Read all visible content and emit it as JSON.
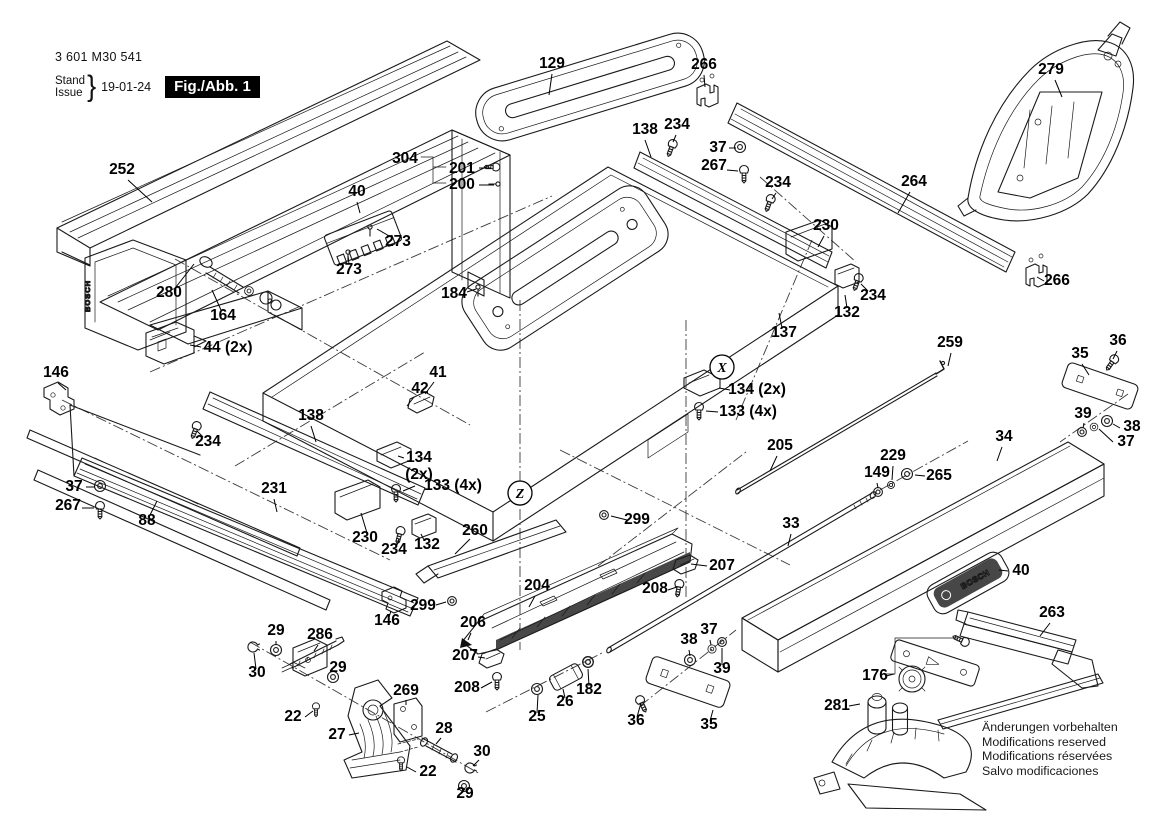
{
  "title_block": {
    "part_number": "3 601 M30 541",
    "stand_label": "Stand",
    "issue_label": "Issue",
    "brace": "}",
    "date": "19-01-24",
    "figure_label": "Fig./Abb. 1"
  },
  "footer_notes": [
    "Änderungen vorbehalten",
    "Modifications reserved",
    "Modifications réservées",
    "Salvo modificaciones"
  ],
  "brand": {
    "logo_text": "BOSCH"
  },
  "colors": {
    "line": "#1a1a1a",
    "label": "#000000",
    "fig_box_bg": "#000000",
    "fig_box_fg": "#ffffff",
    "badge_bg": "#2f2f2f"
  },
  "circled_refs": [
    {
      "letter": "X",
      "x": 722,
      "y": 367
    },
    {
      "letter": "Z",
      "x": 520,
      "y": 493
    }
  ],
  "part_labels": [
    {
      "text": "252",
      "x": 122,
      "y": 174,
      "leader": [
        128,
        180,
        152,
        202
      ]
    },
    {
      "text": "280",
      "x": 169,
      "y": 297,
      "leader": [
        176,
        287,
        194,
        264
      ]
    },
    {
      "text": "164",
      "x": 223,
      "y": 320,
      "leader": [
        221,
        310,
        212,
        290
      ]
    },
    {
      "text": "44 (2x)",
      "x": 228,
      "y": 352,
      "leader": [
        201,
        347,
        190,
        345
      ]
    },
    {
      "text": "146",
      "x": 56,
      "y": 377,
      "leader": [
        58,
        383,
        66,
        390
      ]
    },
    {
      "text": "129",
      "x": 552,
      "y": 68,
      "leader": [
        552,
        74,
        549,
        95
      ]
    },
    {
      "text": "304",
      "x": 405,
      "y": 163
    },
    {
      "text": "201",
      "x": 462,
      "y": 173,
      "leader": [
        479,
        168,
        491,
        168
      ]
    },
    {
      "text": "200",
      "x": 462,
      "y": 189,
      "leader": [
        479,
        185,
        494,
        185
      ]
    },
    {
      "text": "40",
      "x": 357,
      "y": 196,
      "leader": [
        357,
        202,
        360,
        213
      ]
    },
    {
      "text": "273",
      "x": 398,
      "y": 246,
      "leader": [
        391,
        237,
        377,
        229
      ]
    },
    {
      "text": "273",
      "x": 349,
      "y": 274,
      "leader": [
        349,
        264,
        348,
        256
      ]
    },
    {
      "text": "184",
      "x": 454,
      "y": 298,
      "leader": [
        467,
        292,
        476,
        289
      ]
    },
    {
      "text": "266",
      "x": 704,
      "y": 69,
      "leader": [
        704,
        75,
        705,
        87
      ]
    },
    {
      "text": "138",
      "x": 645,
      "y": 134,
      "leader": [
        645,
        140,
        651,
        157
      ]
    },
    {
      "text": "234",
      "x": 677,
      "y": 129,
      "leader": [
        676,
        135,
        673,
        142
      ]
    },
    {
      "text": "37",
      "x": 718,
      "y": 152,
      "leader": [
        729,
        148,
        736,
        148
      ]
    },
    {
      "text": "267",
      "x": 714,
      "y": 170,
      "leader": [
        727,
        170,
        738,
        171
      ]
    },
    {
      "text": "234",
      "x": 778,
      "y": 187,
      "leader": [
        776,
        193,
        772,
        199
      ]
    },
    {
      "text": "264",
      "x": 914,
      "y": 186,
      "leader": [
        910,
        192,
        898,
        213
      ]
    },
    {
      "text": "279",
      "x": 1051,
      "y": 74,
      "leader": [
        1055,
        80,
        1062,
        97
      ]
    },
    {
      "text": "266",
      "x": 1057,
      "y": 285,
      "leader": [
        1044,
        281,
        1037,
        277
      ]
    },
    {
      "text": "230",
      "x": 826,
      "y": 230,
      "leader": [
        824,
        236,
        818,
        247
      ]
    },
    {
      "text": "234",
      "x": 873,
      "y": 300,
      "leader": [
        868,
        291,
        861,
        284
      ]
    },
    {
      "text": "132",
      "x": 847,
      "y": 317,
      "leader": [
        847,
        308,
        845,
        295
      ]
    },
    {
      "text": "137",
      "x": 784,
      "y": 337,
      "leader": [
        782,
        328,
        779,
        313
      ]
    },
    {
      "text": "138",
      "x": 311,
      "y": 420,
      "leader": [
        311,
        426,
        316,
        442
      ]
    },
    {
      "text": "234",
      "x": 208,
      "y": 446,
      "leader": [
        203,
        437,
        197,
        431
      ]
    },
    {
      "text": "37",
      "x": 74,
      "y": 491,
      "leader": [
        86,
        487,
        95,
        487
      ]
    },
    {
      "text": "267",
      "x": 68,
      "y": 510,
      "leader": [
        82,
        508,
        94,
        508
      ]
    },
    {
      "text": "88",
      "x": 147,
      "y": 525,
      "leader": [
        150,
        515,
        157,
        501
      ]
    },
    {
      "text": "231",
      "x": 274,
      "y": 493,
      "leader": [
        274,
        499,
        277,
        512
      ]
    },
    {
      "text": "230",
      "x": 365,
      "y": 542,
      "leader": [
        367,
        533,
        361,
        513
      ]
    },
    {
      "text": "234",
      "x": 394,
      "y": 554,
      "leader": [
        397,
        545,
        399,
        539
      ]
    },
    {
      "text": "132",
      "x": 427,
      "y": 549,
      "leader": [
        424,
        540,
        421,
        534
      ]
    },
    {
      "text": "134",
      "x": 419,
      "y": 462,
      "leader": [
        404,
        458,
        398,
        456
      ]
    },
    {
      "text": "(2x)",
      "x": 419,
      "y": 479
    },
    {
      "text": "133 (4x)",
      "x": 453,
      "y": 490,
      "leader": [
        415,
        486,
        403,
        491
      ]
    },
    {
      "text": "41",
      "x": 438,
      "y": 377,
      "leader": [
        434,
        382,
        425,
        394
      ]
    },
    {
      "text": "42",
      "x": 420,
      "y": 393,
      "leader": [
        414,
        397,
        407,
        406
      ]
    },
    {
      "text": "134 (2x)",
      "x": 757,
      "y": 394,
      "leader": [
        730,
        390,
        719,
        388
      ]
    },
    {
      "text": "133 (4x)",
      "x": 748,
      "y": 416,
      "leader": [
        718,
        412,
        706,
        411
      ]
    },
    {
      "text": "260",
      "x": 475,
      "y": 535,
      "leader": [
        470,
        539,
        455,
        554
      ]
    },
    {
      "text": "299",
      "x": 423,
      "y": 610,
      "leader": [
        436,
        605,
        446,
        602
      ]
    },
    {
      "text": "206",
      "x": 473,
      "y": 627,
      "leader": [
        471,
        633,
        468,
        640
      ]
    },
    {
      "text": "204",
      "x": 537,
      "y": 590,
      "leader": [
        535,
        596,
        529,
        607
      ]
    },
    {
      "text": "207",
      "x": 722,
      "y": 570,
      "leader": [
        707,
        566,
        691,
        564
      ]
    },
    {
      "text": "208",
      "x": 655,
      "y": 593,
      "leader": [
        668,
        590,
        677,
        587
      ]
    },
    {
      "text": "207",
      "x": 465,
      "y": 660,
      "leader": [
        478,
        657,
        485,
        658
      ]
    },
    {
      "text": "208",
      "x": 467,
      "y": 692,
      "leader": [
        481,
        688,
        492,
        682
      ]
    },
    {
      "text": "299",
      "x": 637,
      "y": 524,
      "leader": [
        627,
        520,
        611,
        516
      ]
    },
    {
      "text": "33",
      "x": 791,
      "y": 528,
      "leader": [
        791,
        534,
        788,
        546
      ]
    },
    {
      "text": "205",
      "x": 780,
      "y": 450,
      "leader": [
        777,
        456,
        770,
        471
      ]
    },
    {
      "text": "259",
      "x": 950,
      "y": 347,
      "leader": [
        951,
        353,
        948,
        366
      ]
    },
    {
      "text": "229",
      "x": 893,
      "y": 460,
      "leader": [
        893,
        466,
        892,
        480
      ]
    },
    {
      "text": "149",
      "x": 877,
      "y": 477,
      "leader": [
        877,
        483,
        878,
        488
      ]
    },
    {
      "text": "265",
      "x": 939,
      "y": 480,
      "leader": [
        925,
        476,
        915,
        475
      ]
    },
    {
      "text": "34",
      "x": 1004,
      "y": 441,
      "leader": [
        1002,
        447,
        997,
        461
      ]
    },
    {
      "text": "35",
      "x": 1080,
      "y": 358,
      "leader": [
        1082,
        364,
        1089,
        375
      ]
    },
    {
      "text": "36",
      "x": 1118,
      "y": 345,
      "leader": [
        1117,
        351,
        1113,
        359
      ]
    },
    {
      "text": "39",
      "x": 1083,
      "y": 418,
      "leader": [
        1084,
        423,
        1083,
        428
      ]
    },
    {
      "text": "38",
      "x": 1132,
      "y": 431,
      "leader": [
        1120,
        428,
        1113,
        424
      ]
    },
    {
      "text": "37",
      "x": 1126,
      "y": 446,
      "leader": [
        1113,
        442,
        1099,
        429
      ]
    },
    {
      "text": "38",
      "x": 689,
      "y": 644,
      "leader": [
        689,
        650,
        690,
        656
      ]
    },
    {
      "text": "37",
      "x": 709,
      "y": 634,
      "leader": [
        710,
        640,
        711,
        645
      ]
    },
    {
      "text": "39",
      "x": 722,
      "y": 673,
      "leader": [
        722,
        665,
        722,
        648
      ]
    },
    {
      "text": "36",
      "x": 636,
      "y": 725,
      "leader": [
        637,
        717,
        641,
        703
      ]
    },
    {
      "text": "35",
      "x": 709,
      "y": 729,
      "leader": [
        710,
        721,
        713,
        710
      ]
    },
    {
      "text": "25",
      "x": 537,
      "y": 721,
      "leader": [
        537,
        713,
        538,
        695
      ]
    },
    {
      "text": "26",
      "x": 565,
      "y": 706,
      "leader": [
        565,
        698,
        563,
        689
      ]
    },
    {
      "text": "182",
      "x": 589,
      "y": 694,
      "leader": [
        589,
        686,
        588,
        669
      ]
    },
    {
      "text": "269",
      "x": 406,
      "y": 695,
      "leader": [
        406,
        700,
        406,
        705
      ]
    },
    {
      "text": "28",
      "x": 444,
      "y": 733,
      "leader": [
        441,
        738,
        436,
        744
      ]
    },
    {
      "text": "30",
      "x": 482,
      "y": 756,
      "leader": [
        479,
        760,
        473,
        766
      ]
    },
    {
      "text": "29",
      "x": 465,
      "y": 798,
      "leader": [
        465,
        790,
        464,
        789
      ]
    },
    {
      "text": "22",
      "x": 428,
      "y": 776,
      "leader": [
        416,
        772,
        407,
        767
      ]
    },
    {
      "text": "27",
      "x": 337,
      "y": 739,
      "leader": [
        349,
        735,
        359,
        733
      ]
    },
    {
      "text": "22",
      "x": 293,
      "y": 721,
      "leader": [
        305,
        717,
        313,
        711
      ]
    },
    {
      "text": "29",
      "x": 276,
      "y": 635,
      "leader": [
        276,
        641,
        276,
        645
      ]
    },
    {
      "text": "286",
      "x": 320,
      "y": 639,
      "leader": [
        318,
        645,
        314,
        651
      ]
    },
    {
      "text": "30",
      "x": 257,
      "y": 677,
      "leader": [
        256,
        669,
        254,
        653
      ]
    },
    {
      "text": "29",
      "x": 338,
      "y": 672
    },
    {
      "text": "146",
      "x": 387,
      "y": 625,
      "leader": [
        389,
        617,
        391,
        611
      ]
    },
    {
      "text": "176",
      "x": 875,
      "y": 680,
      "leader": [
        886,
        676,
        894,
        674
      ]
    },
    {
      "text": "281",
      "x": 837,
      "y": 710,
      "leader": [
        849,
        706,
        860,
        704
      ]
    },
    {
      "text": "40",
      "x": 1021,
      "y": 575,
      "leader": [
        1008,
        571,
        999,
        570
      ]
    },
    {
      "text": "263",
      "x": 1052,
      "y": 617,
      "leader": [
        1050,
        623,
        1040,
        636
      ]
    }
  ]
}
